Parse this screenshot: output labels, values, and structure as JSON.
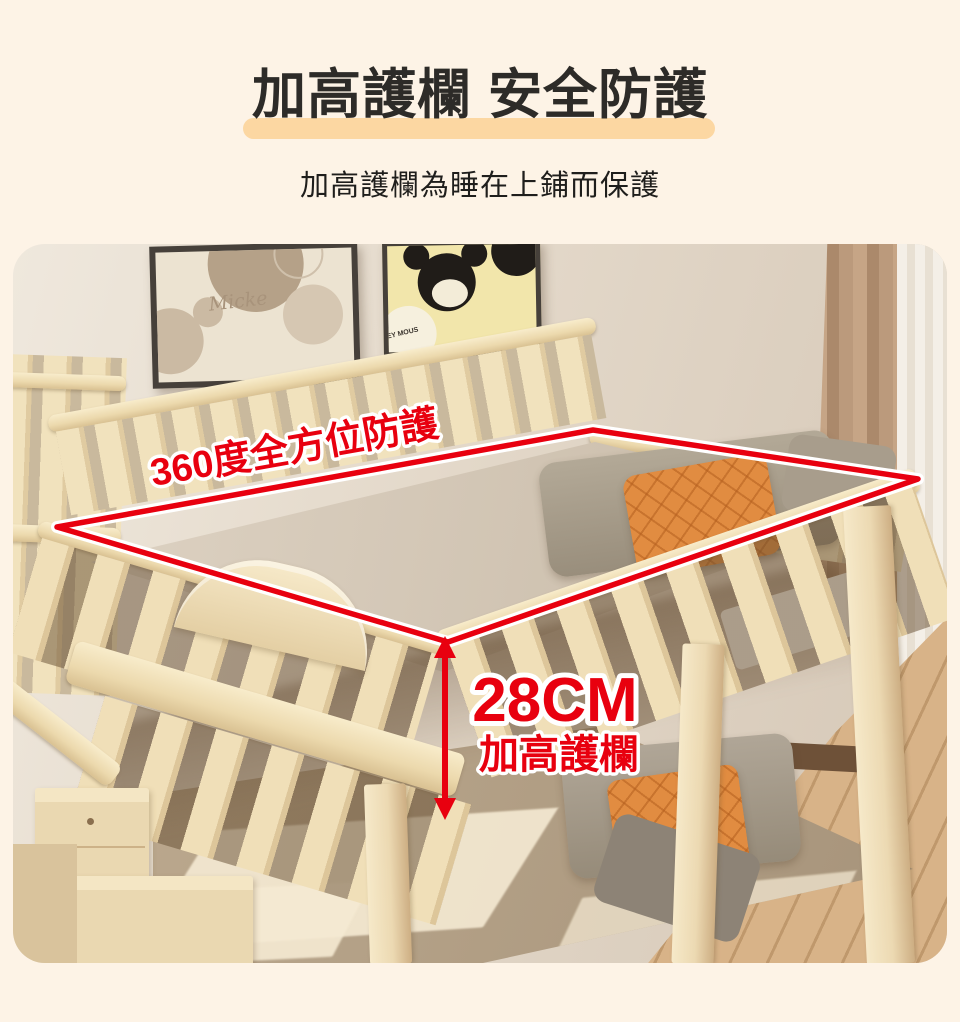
{
  "page": {
    "background_color": "#fdf3e6"
  },
  "header": {
    "title": "加高護欄 安全防護",
    "subtitle": "加高護欄為睡在上鋪而保護",
    "highlight_color": "#fcd7a2",
    "title_color": "#2d2b28"
  },
  "photo": {
    "annotations": {
      "perimeter_label": "360度全方位防護",
      "measurement_value": "28CM",
      "measurement_label": "加高護欄",
      "accent_color": "#e8000f",
      "outline_casing_color": "#ffffff"
    },
    "posters": {
      "left_text": "Micke",
      "right_badge_text": "EY MOUS"
    }
  }
}
